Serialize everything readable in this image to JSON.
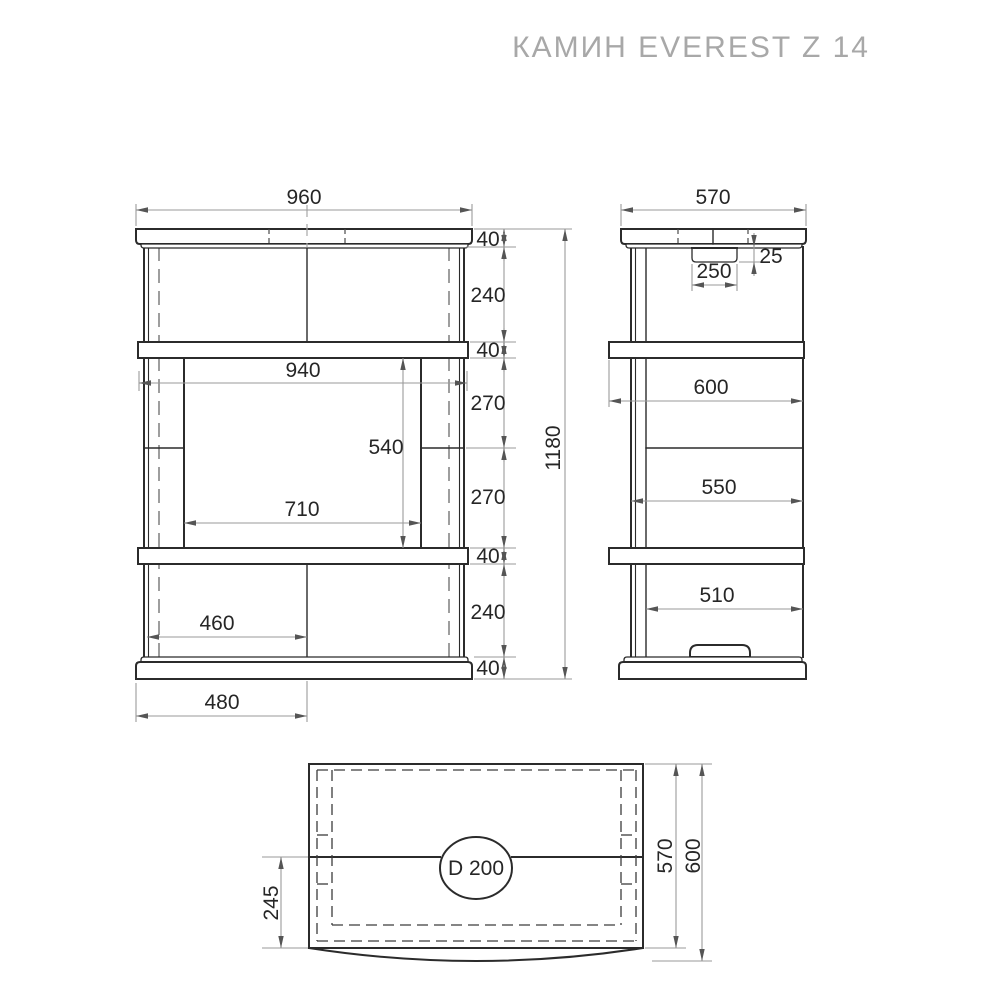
{
  "title": "КАМИН EVEREST Z 14",
  "front": {
    "overall_width": "960",
    "overall_height": "1180",
    "chain": [
      "40",
      "240",
      "40",
      "270",
      "270",
      "40",
      "240",
      "40"
    ],
    "shelf_width": "940",
    "opening_height": "540",
    "opening_width": "710",
    "lower_inner_width": "460",
    "base_half_width": "480"
  },
  "side": {
    "cap_depth": "570",
    "collar_height": "25",
    "collar_width": "250",
    "shelf_depth": "600",
    "body_depth": "550",
    "inner_depth": "510"
  },
  "top": {
    "flue_diameter": "D 200",
    "flue_offset": "245",
    "body_depth": "570",
    "total_depth": "600"
  }
}
